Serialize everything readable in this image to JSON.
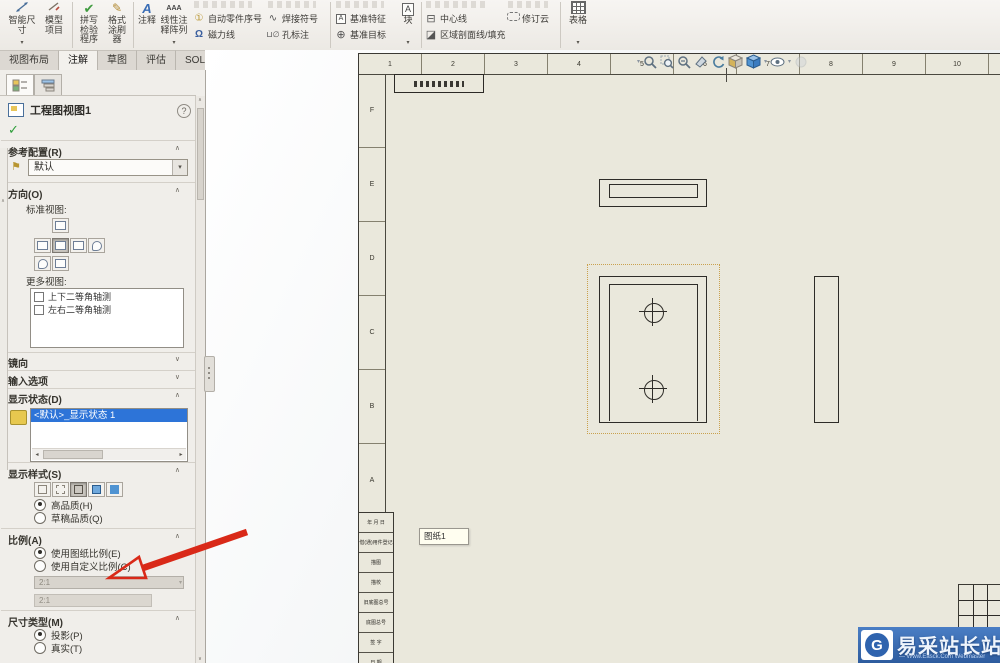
{
  "colors": {
    "accent_blue": "#2d74d8",
    "sheet_beige": "#eae8dc",
    "arrow_red": "#d92918",
    "watermark_blue": "#3a69ad",
    "selection_orange": "#c9a14e"
  },
  "ribbon": {
    "smart_dimension": "智能尺寸",
    "model_items": "模型项目",
    "spell_checker": "拼写检验程序",
    "format_painter": "格式涂刷器",
    "note": "注释",
    "linear_note_pattern": "线性注释阵列",
    "auto_balloon": "自动零件序号",
    "magnetic_line": "磁力线",
    "weld_symbol": "焊接符号",
    "hole_callout": "孔标注",
    "datum_feature": "基准特征",
    "datum_target": "基准目标",
    "block": "块",
    "centerline": "中心线",
    "area_hatch": "区域剖面线/填充",
    "revision_cloud": "修订云",
    "table": "表格"
  },
  "command_tabs": [
    {
      "label": "视图布局"
    },
    {
      "label": "注解",
      "selected": true
    },
    {
      "label": "草图"
    },
    {
      "label": "评估"
    },
    {
      "label": "SOLIDWORKS 插件"
    },
    {
      "label": "图纸格式"
    }
  ],
  "property_panel": {
    "title": "工程图视图1",
    "help": "?",
    "ok_check": "✓",
    "sections": {
      "reference_config": {
        "label": "参考配置(R)",
        "value": "默认"
      },
      "orientation": {
        "label": "方向(O)",
        "standard_views": "标准视图:",
        "more_views": "更多视图:",
        "view_buttons_row1": [
          {}
        ],
        "view_buttons_row2": [
          {},
          {
            "selected": true
          },
          {},
          {
            "cls": "iso"
          }
        ],
        "view_buttons_row3": [
          {
            "cls": "iso"
          },
          {}
        ],
        "more_view_items": [
          {
            "label": "上下二等角轴测"
          },
          {
            "label": "左右二等角轴测"
          }
        ]
      },
      "mirror": {
        "label": "镜向"
      },
      "import_options": {
        "label": "输入选项"
      },
      "display_state": {
        "label": "显示状态(D)",
        "items": [
          {
            "label": "<默认>_显示状态 1",
            "selected": true
          }
        ]
      },
      "display_style": {
        "label": "显示样式(S)",
        "style_buttons": [
          {
            "cls": "wire"
          },
          {
            "cls": "hlv"
          },
          {
            "cls": "hlr",
            "selected": true
          },
          {
            "cls": "shd-e"
          },
          {
            "cls": "shd"
          }
        ],
        "quality": [
          {
            "label": "高品质(H)",
            "selected": true
          },
          {
            "label": "草稿品质(Q)"
          }
        ]
      },
      "scale": {
        "label": "比例(A)",
        "options": [
          {
            "label": "使用图纸比例(E)",
            "selected": true
          },
          {
            "label": "使用自定义比例(C)"
          }
        ],
        "combo_value": "2:1",
        "custom_value": "2:1"
      },
      "dimension_type": {
        "label": "尺寸类型(M)",
        "options": [
          {
            "label": "投影(P)",
            "selected": true
          },
          {
            "label": "真实(T)"
          }
        ]
      }
    }
  },
  "drawing": {
    "sheet_tooltip": "图纸1",
    "zone_numbers": [
      "1",
      "2",
      "3",
      "4",
      "5",
      "6",
      "7",
      "8",
      "9",
      "10"
    ],
    "zone_letters": [
      "F",
      "E",
      "D",
      "C",
      "B",
      "A"
    ],
    "border_table_rows": [
      "年 月 日",
      "借(通)用件登记",
      "描图",
      "描校",
      "旧底图总号",
      "底图总号",
      "签 字",
      "日 期"
    ],
    "hud_icons": [
      "zoom-fit",
      "zoom-area",
      "zoom-in-out",
      "section-view",
      "rotate-view",
      "view-orientation",
      "display-style",
      "hide-show-items",
      "view-settings",
      "appearance"
    ]
  },
  "watermark": {
    "brand": "易采站长站",
    "tagline": "— Www.Easck.Com Webmaster"
  }
}
